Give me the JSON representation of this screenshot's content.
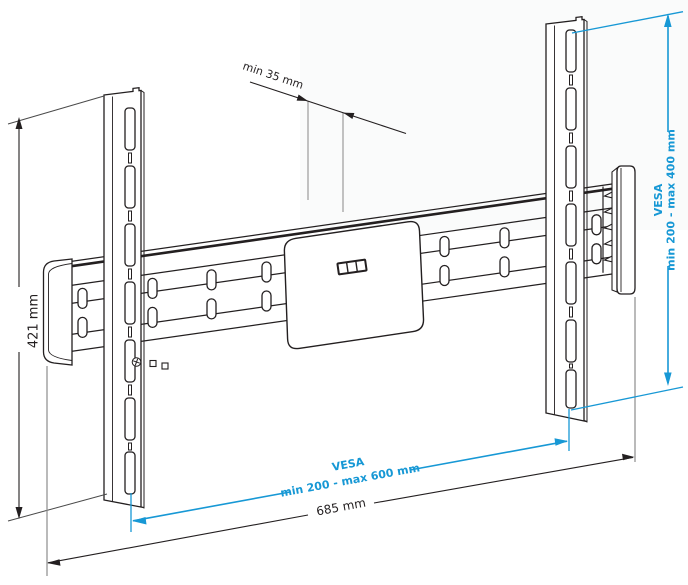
{
  "drawing": {
    "annotations": {
      "min_depth": "min 35 mm",
      "bracket_height": "421 mm",
      "rail_width": "685 mm",
      "vesa_vertical_label": "VESA",
      "vesa_vertical_range": "min 200 - max 400 mm",
      "vesa_horizontal_label": "VESA",
      "vesa_horizontal_range": "min 200 - max 600 mm"
    },
    "colors": {
      "dimension_accent": "#1798d5",
      "line_art": "#231f20",
      "extension_gray": "#8c8c8c"
    }
  }
}
